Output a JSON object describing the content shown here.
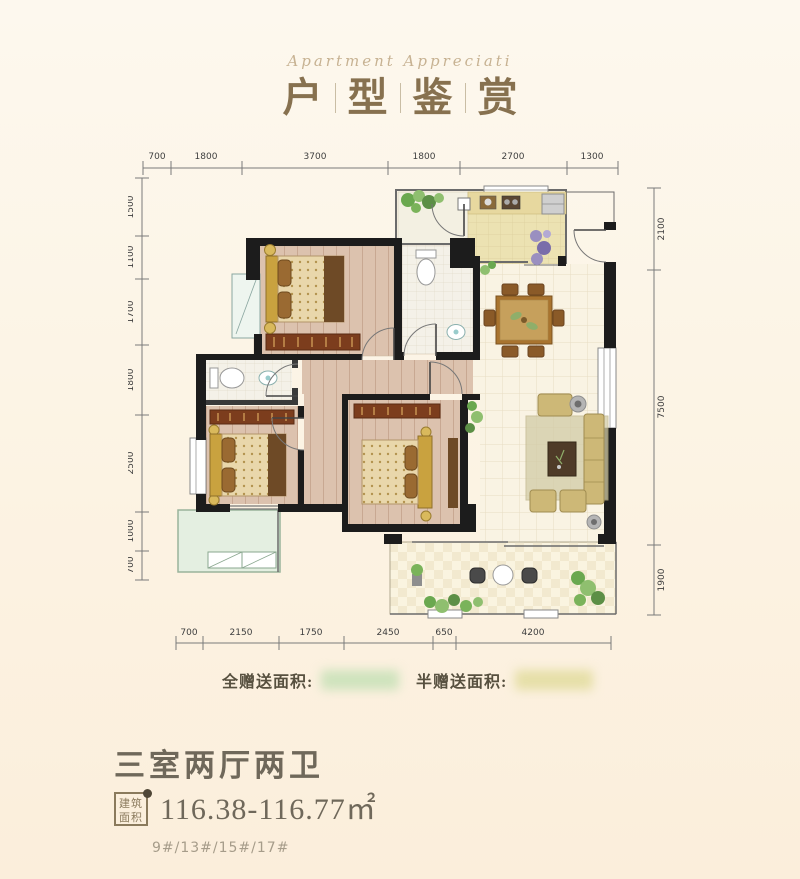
{
  "header": {
    "subtitle": "Apartment Appreciati",
    "title_chars": [
      "户",
      "型",
      "鉴",
      "赏"
    ]
  },
  "plan": {
    "dims": {
      "top": [
        "700",
        "1800",
        "3700",
        "1800",
        "2700",
        "1300"
      ],
      "left": [
        "1500",
        "1100",
        "1700",
        "1800",
        "2500",
        "1000",
        "700"
      ],
      "right": [
        "2100",
        "7500",
        "1900"
      ],
      "bottom": [
        "700",
        "2150",
        "1750",
        "2450",
        "650",
        "4200"
      ]
    },
    "gift_full_label": "全赠送面积:",
    "gift_half_label": "半赠送面积:",
    "rooms": [
      "bedroom-2",
      "bathroom-a",
      "kitchen",
      "utility-balcony",
      "entry",
      "dining-living",
      "corridor",
      "bathroom-b",
      "master-bedroom",
      "bedroom-3",
      "left-balcony",
      "bottom-balcony"
    ]
  },
  "footer": {
    "layout_title": "三室两厅两卫",
    "area_badge_line1": "建筑",
    "area_badge_line2": "面积",
    "area_value": "116.38-116.77㎡",
    "buildings": "9#/13#/15#/17#"
  },
  "colors": {
    "wall": "#1c1c1c",
    "wood_floor": "#dcc2ae",
    "tile_floor": "#f9f3e3",
    "kitchen_floor": "#ece2b2",
    "balcony_green": "#e4efe1",
    "bed_gold": "#c9a23f",
    "wardrobe": "#7c3d1d",
    "sofa": "#cdb877",
    "title_bronze": "#87714f",
    "text_dark": "#6f685a"
  }
}
